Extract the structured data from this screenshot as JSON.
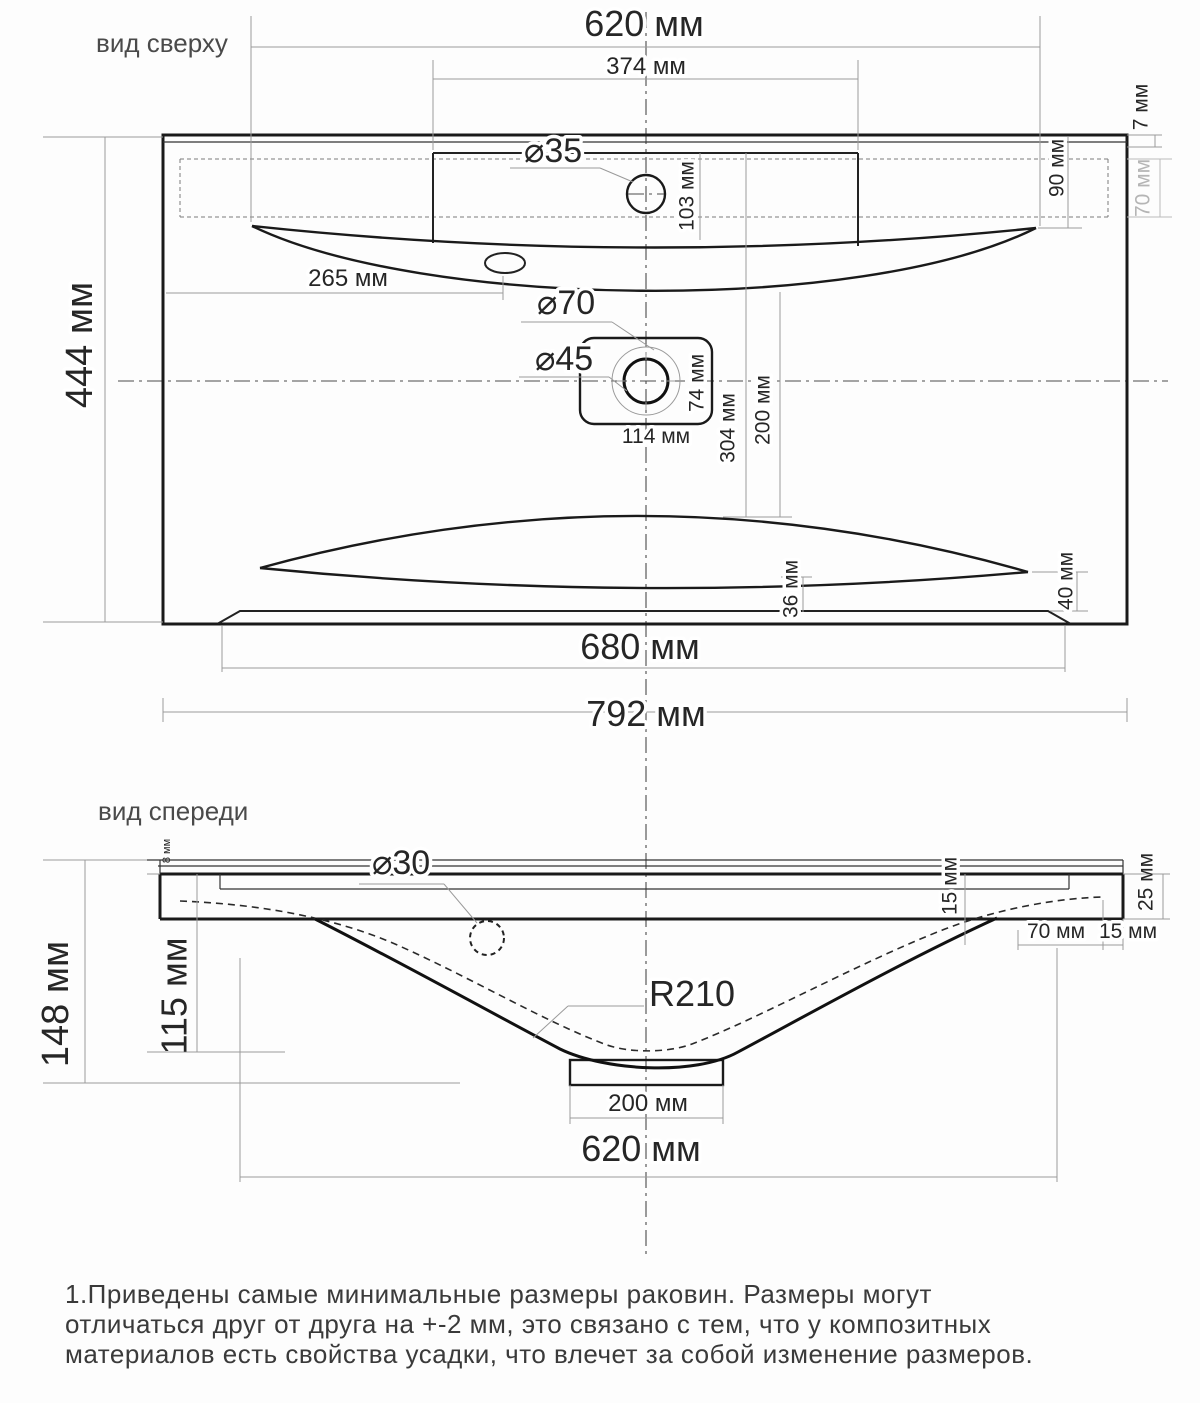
{
  "drawing": {
    "top_view": {
      "title": "вид сверху",
      "width_620": "620 мм",
      "width_374": "374 мм",
      "rim_7": "7 мм",
      "depth_90": "90 мм",
      "depth_70": "70 мм",
      "faucet_dia_35": "⌀35",
      "offset_103": "103 мм",
      "offset_265": "265 мм",
      "recess_dia_70": "⌀70",
      "drain_dia_45": "⌀45",
      "drain_box_74": "74 мм",
      "drain_box_114": "114 мм",
      "depth_304": "304 мм",
      "depth_200": "200 мм",
      "height_444": "444 мм",
      "ledge_36": "36 мм",
      "ledge_40": "40 мм",
      "base_680": "680 мм",
      "total_792": "792 мм"
    },
    "front_view": {
      "title": "вид спереди",
      "rim_8": "8 мм",
      "hole_dia_30": "⌀30",
      "edge_15": "15 мм",
      "edge_25": "25 мм",
      "offset_70": "70 мм",
      "offset_15": "15 мм",
      "bowl_depth_115": "115 мм",
      "total_height_148": "148 мм",
      "radius_210": "R210",
      "drain_width_200": "200 мм",
      "bowl_width_620": "620 мм"
    },
    "notes": {
      "line1": "1.Приведены самые минимальные размеры раковин. Размеры могут",
      "line2": "отличаться друг от друга на +-2 мм, это связано с тем, что у композитных",
      "line3": "материалов есть свойства усадки, что влечет за собой изменение размеров."
    }
  }
}
